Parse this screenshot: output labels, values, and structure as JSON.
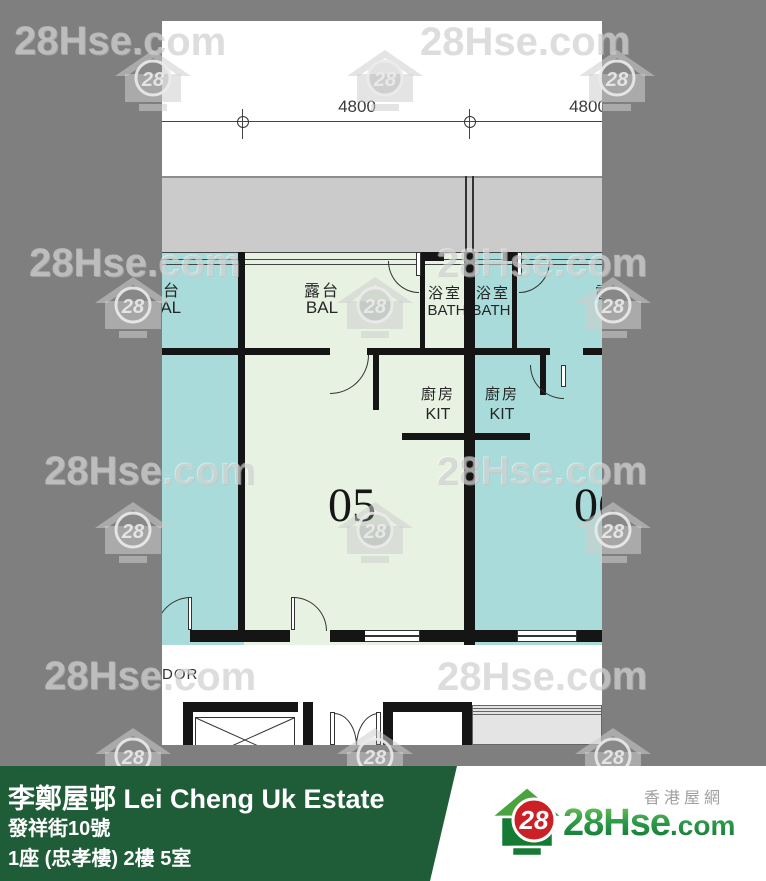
{
  "watermark": {
    "text": "28Hse.com",
    "logo_number": "28"
  },
  "plan": {
    "dimension_labels": [
      "4800",
      "4800"
    ],
    "room_labels": {
      "balcony": {
        "cn": "露台",
        "en": "BAL"
      },
      "bath": {
        "cn": "浴室",
        "en": "BATH"
      },
      "kitchen": {
        "cn": "廚房",
        "en": "KIT"
      }
    },
    "unit_numbers": [
      "05",
      "06"
    ],
    "corridor_text": "DOR"
  },
  "banner": {
    "estate_title": "李鄭屋邨 Lei Cheng Uk Estate",
    "address_line": "發祥街10號",
    "unit_line": "1座 (忠孝樓) 2樓 5室",
    "logo": {
      "number": "28",
      "brand": "28Hse",
      "suffix": ".com",
      "site_name_cn": "香港屋網"
    }
  },
  "colors": {
    "background": "#7f7f7f",
    "plan_background": "#ffffff",
    "upper_band_gray": "#cbcbcb",
    "unit_left_teal": "#a8dbd9",
    "unit_05_green": "#e7f2e2",
    "unit_06_teal": "#a8dbd9",
    "stairs_gray": "#e4e4e4",
    "wall_black": "#151515",
    "banner_green": "#1f5c38",
    "logo_red": "#cc2027",
    "logo_green": "#1e8a3c"
  }
}
